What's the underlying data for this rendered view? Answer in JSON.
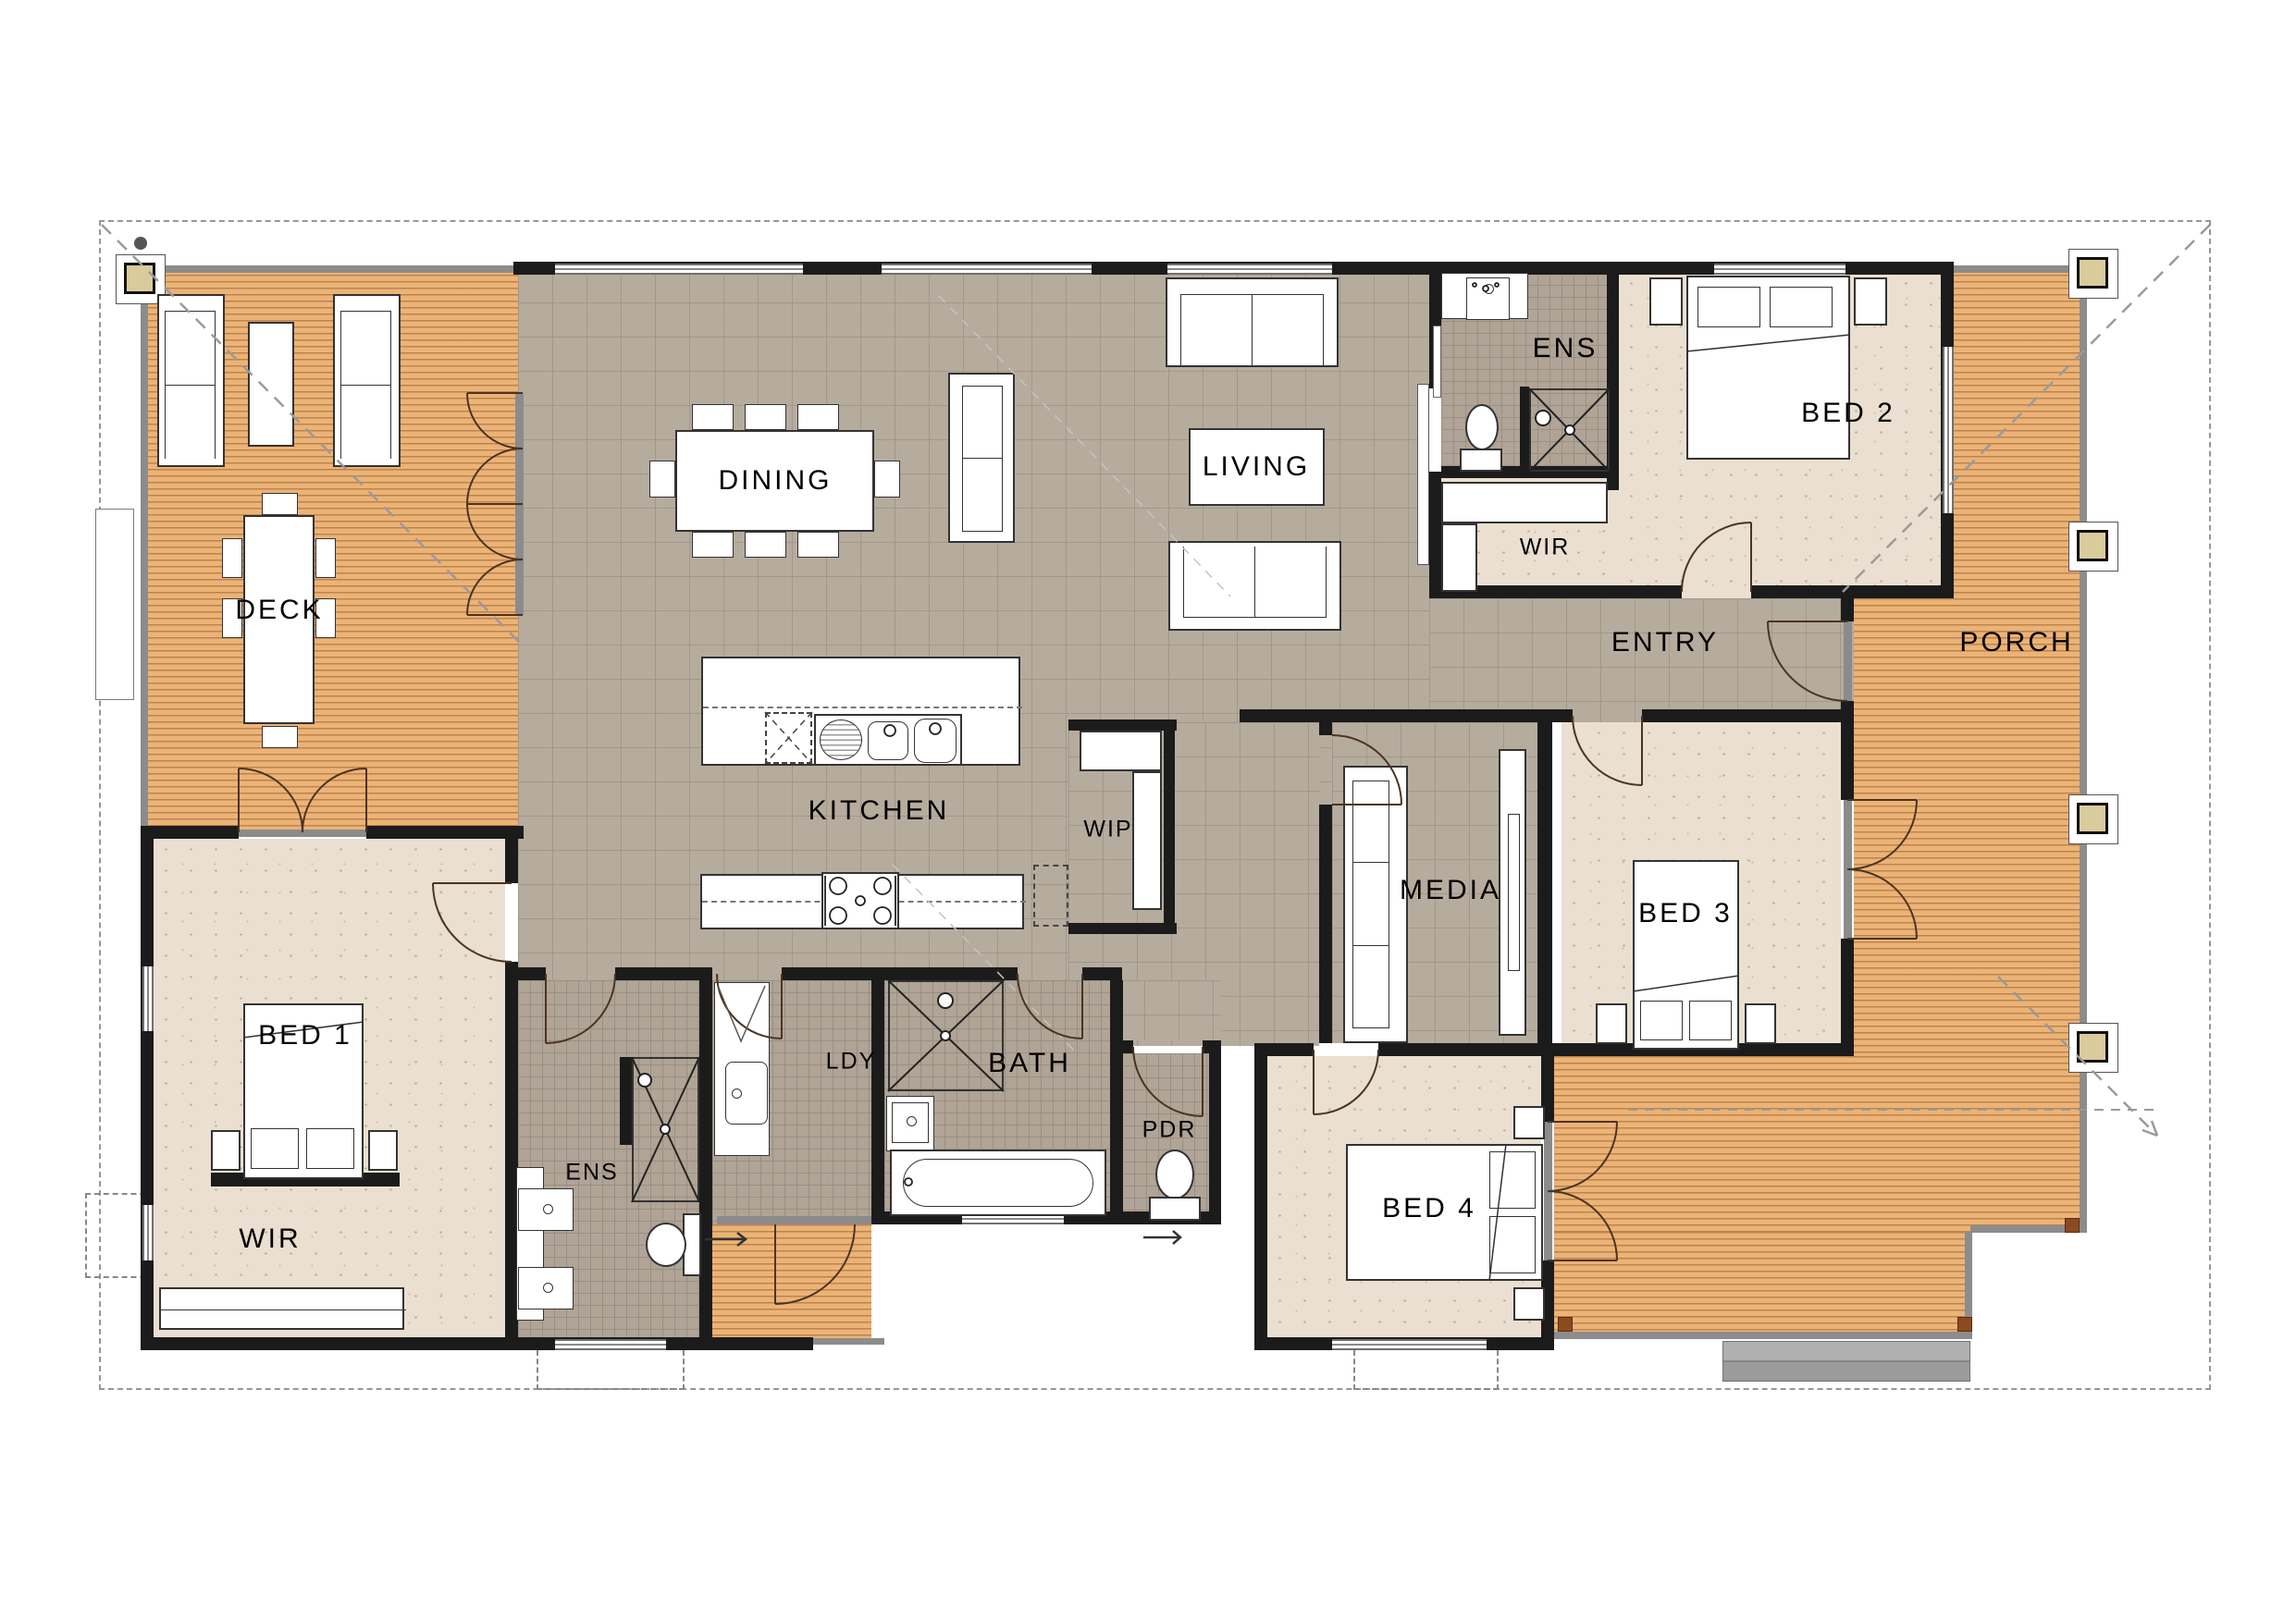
{
  "title": "Single storey house floor plan",
  "colors": {
    "wall": "#1b1b1b",
    "tile": "#b6ac9e",
    "tileLine": "#a29889",
    "bathTile": "#b0a496",
    "bathLine": "#9a8f82",
    "carpet": "#eadfd0",
    "speckle": "#bfab8e",
    "wood": "#ecb377",
    "woodLine": "#c28a50",
    "outline": "#979797",
    "postFill": "#dacb9d",
    "step": "#a5a5a5"
  },
  "rooms": {
    "deck": {
      "label": "DECK"
    },
    "dining": {
      "label": "DINING"
    },
    "kitchen": {
      "label": "KITCHEN"
    },
    "wip": {
      "label": "WIP"
    },
    "living": {
      "label": "LIVING"
    },
    "ens_bed2": {
      "label": "ENS"
    },
    "wir_bed2": {
      "label": "WIR"
    },
    "bed2": {
      "label": "BED 2"
    },
    "entry": {
      "label": "ENTRY"
    },
    "porch": {
      "label": "PORCH"
    },
    "media": {
      "label": "MEDIA"
    },
    "bed3": {
      "label": "BED 3"
    },
    "bed1": {
      "label": "BED 1"
    },
    "wir_bed1": {
      "label": "WIR"
    },
    "ens_bed1": {
      "label": "ENS"
    },
    "ldy": {
      "label": "LDY"
    },
    "bath": {
      "label": "BATH"
    },
    "pdr": {
      "label": "PDR"
    },
    "bed4": {
      "label": "BED 4"
    }
  }
}
